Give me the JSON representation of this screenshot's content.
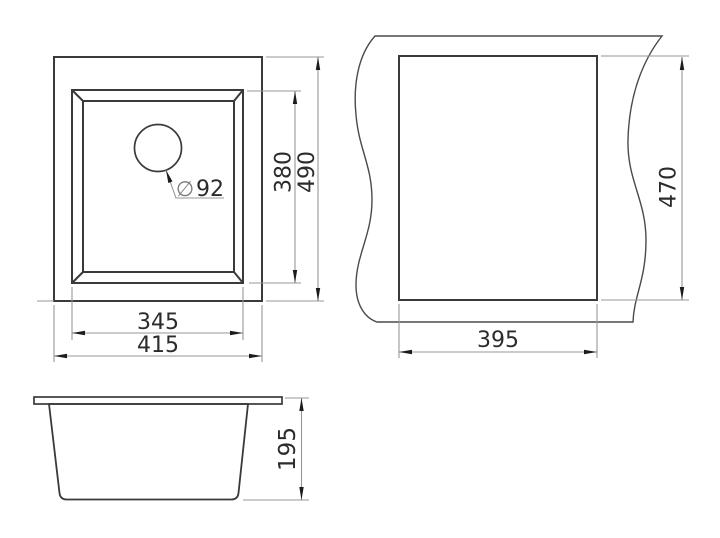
{
  "drawing": {
    "kind": "sink-technical-drawing",
    "colors": {
      "background": "#ffffff",
      "outline": "#3a3a3a",
      "dimension_lines": "#979797",
      "arrows": "#1c1c1c",
      "text": "#2b2b2b"
    },
    "top_view": {
      "dim_bowl_width": "345",
      "dim_overall_width": "415",
      "dim_bowl_depth": "380",
      "dim_overall_depth": "490",
      "drain_symbol": "∅",
      "drain_diameter": "92"
    },
    "cutout_view": {
      "dim_width": "395",
      "dim_height": "470"
    },
    "side_view": {
      "dim_height": "195"
    }
  }
}
